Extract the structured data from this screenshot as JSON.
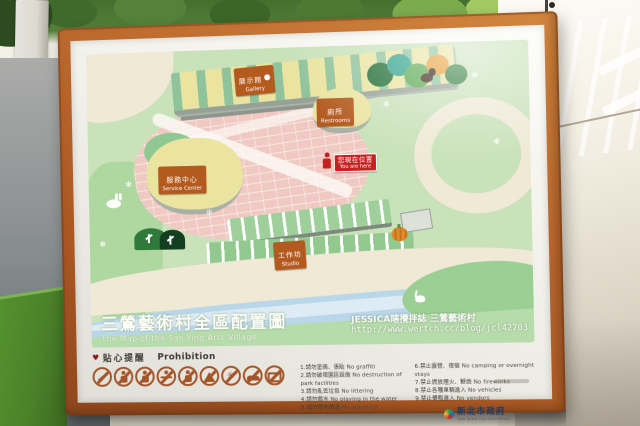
{
  "sign": {
    "map": {
      "labels": {
        "gallery": {
          "zh": "展示館",
          "en": "Gallery"
        },
        "restrooms": {
          "zh": "廁所",
          "en": "Restrooms"
        },
        "service_center": {
          "zh": "服務中心",
          "en": "Service Center"
        },
        "you_are_here": {
          "zh": "您現在位置",
          "en": "You are here"
        },
        "studio": {
          "zh": "工作坊",
          "en": "Studio"
        }
      },
      "title": {
        "zh": "三鶯藝術村全區配置圖",
        "en": "The Map of the San-Ying Arts Village"
      }
    },
    "watermark": {
      "line1": "JESSICA瞎攪拌誌 三鶯藝術村",
      "line2": "http://www.wertch.cc/blog/jcl42703"
    },
    "prohibition": {
      "heart": "♥",
      "title_zh": "貼心提醒",
      "title_en": "Prohibition",
      "icons": [
        "no-graffiti",
        "no-destruction-of-facilities",
        "no-littering",
        "no-playing-in-water",
        "no-urinating",
        "no-camping",
        "no-fireworks",
        "no-vehicles",
        "no-vendors"
      ],
      "items": [
        {
          "num": "1.",
          "zh": "請勿塗鴉、張貼",
          "en": "No graffiti"
        },
        {
          "num": "2.",
          "zh": "請勿破壞園區設施",
          "en": "No destruction of park facilities"
        },
        {
          "num": "3.",
          "zh": "請勿亂丟垃圾",
          "en": "No littering"
        },
        {
          "num": "4.",
          "zh": "請勿戲水",
          "en": "No playing in the water"
        },
        {
          "num": "5.",
          "zh": "請勿隨地便溺",
          "en": "No urinating"
        },
        {
          "num": "6.",
          "zh": "禁止露營、夜宿",
          "en": "No camping or overnight stays"
        },
        {
          "num": "7.",
          "zh": "禁止燃放煙火、鞭炮",
          "en": "No fireworks"
        },
        {
          "num": "8.",
          "zh": "禁止各種車輛進入",
          "en": "No vehicles"
        },
        {
          "num": "9.",
          "zh": "禁止攤販進入",
          "en": "No vendors"
        }
      ]
    },
    "logo": {
      "zh": "新北市政府",
      "en": "New Taipei City Government"
    }
  },
  "colors": {
    "frame_orange": "#b05a24",
    "label_orange": "#b35a1f",
    "you_are_here_red": "#c42121",
    "map_green": "#c9e2ba",
    "path_cream": "#efe9d6",
    "plaza_pink": "#efc9c2",
    "stream_blue": "#b9d7e9"
  }
}
